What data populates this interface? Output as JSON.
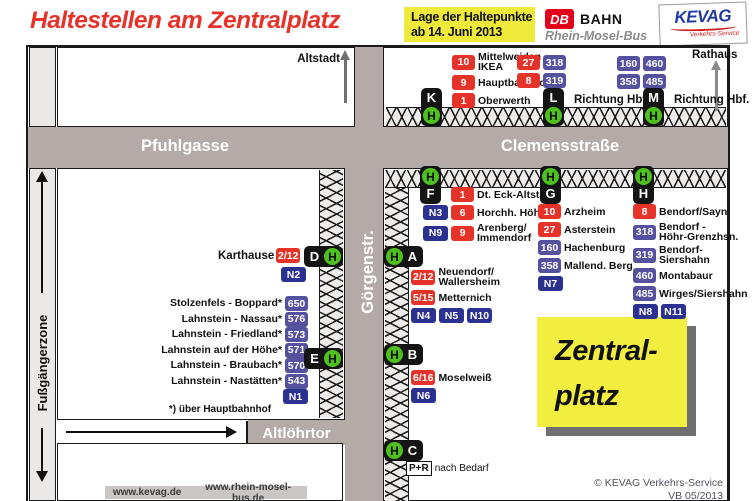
{
  "h_sign": "H",
  "header": {
    "title": "Haltestellen am Zentralplatz",
    "date_box": {
      "line1": "Lage der Haltepunkte",
      "line2": "ab 14. Juni 2013"
    },
    "db_logo": {
      "db": "DB",
      "bahn": "BAHN",
      "sub": "Rhein-Mosel-Bus"
    },
    "kevag_logo": {
      "name": "KEVAG",
      "sub": "Verkehrs-Service"
    }
  },
  "streets": {
    "pfuhlgasse": "Pfuhlgasse",
    "clemensstrasse": "Clemensstraße",
    "goergenstr": "Görgenstr.",
    "altloehrtor": "Altlöhrtor",
    "fussgaengerzone": "Fußgängerzone"
  },
  "landmarks": {
    "altstadt": "Altstadt",
    "rathaus": "Rathaus",
    "zentralplatz_line1": "Zentral-",
    "zentralplatz_line2": "platz"
  },
  "stops": {
    "K": {
      "letter": "K",
      "rows": [
        {
          "chips": [
            {
              "t": "10",
              "c": "red"
            }
          ],
          "label": "Mittelweiden\nIKEA"
        },
        {
          "chips": [
            {
              "t": "9",
              "c": "red"
            }
          ],
          "label": "Hauptbahnhof"
        },
        {
          "chips": [
            {
              "t": "1",
              "c": "red"
            }
          ],
          "label": "Oberwerth"
        }
      ]
    },
    "L": {
      "letter": "L",
      "direction": "Richtung Hbf.",
      "rows": [
        {
          "chips": [
            {
              "t": "27",
              "c": "red"
            },
            {
              "t": "318",
              "c": "pur"
            }
          ],
          "label": ""
        },
        {
          "chips": [
            {
              "t": "8",
              "c": "red"
            },
            {
              "t": "319",
              "c": "pur"
            }
          ],
          "label": ""
        }
      ]
    },
    "M": {
      "letter": "M",
      "direction": "Richtung Hbf.",
      "rows": [
        {
          "chips": [
            {
              "t": "160",
              "c": "pur"
            },
            {
              "t": "460",
              "c": "pur"
            }
          ],
          "label": ""
        },
        {
          "chips": [
            {
              "t": "358",
              "c": "pur"
            },
            {
              "t": "485",
              "c": "pur"
            }
          ],
          "label": ""
        }
      ]
    },
    "F": {
      "letter": "F",
      "rows": [
        {
          "chips": [
            {
              "t": "",
              "c": "sp"
            },
            {
              "t": "1",
              "c": "red"
            }
          ],
          "label": "Dt. Eck-Altstadt"
        },
        {
          "chips": [
            {
              "t": "N3",
              "c": "navy"
            },
            {
              "t": "6",
              "c": "red"
            }
          ],
          "label": "Horchh. Höhe"
        },
        {
          "chips": [
            {
              "t": "N9",
              "c": "navy"
            },
            {
              "t": "9",
              "c": "red"
            }
          ],
          "label": "Arenberg/\nImmendorf"
        }
      ]
    },
    "G": {
      "letter": "G",
      "rows": [
        {
          "chips": [
            {
              "t": "10",
              "c": "red"
            }
          ],
          "label": "Arzheim"
        },
        {
          "chips": [
            {
              "t": "27",
              "c": "red"
            }
          ],
          "label": "Asterstein"
        },
        {
          "chips": [
            {
              "t": "160",
              "c": "pur"
            }
          ],
          "label": "Hachenburg"
        },
        {
          "chips": [
            {
              "t": "358",
              "c": "pur"
            }
          ],
          "label": "Mallend. Berg"
        },
        {
          "chips": [
            {
              "t": "N7",
              "c": "navy"
            }
          ],
          "label": ""
        }
      ]
    },
    "H": {
      "letter": "H",
      "rows": [
        {
          "chips": [
            {
              "t": "8",
              "c": "red"
            }
          ],
          "label": "Bendorf/Sayn"
        },
        {
          "chips": [
            {
              "t": "318",
              "c": "pur"
            }
          ],
          "label": "Bendorf -\nHöhr-Grenzhsn."
        },
        {
          "chips": [
            {
              "t": "319",
              "c": "pur"
            }
          ],
          "label": "Bendorf-\nSiershahn"
        },
        {
          "chips": [
            {
              "t": "460",
              "c": "pur"
            }
          ],
          "label": "Montabaur"
        },
        {
          "chips": [
            {
              "t": "485",
              "c": "pur"
            }
          ],
          "label": "Wirges/Siershahn"
        },
        {
          "chips": [
            {
              "t": "N8",
              "c": "navy"
            },
            {
              "t": "N11",
              "c": "navy"
            }
          ],
          "label": ""
        }
      ]
    },
    "A": {
      "letter": "A",
      "rows": [
        {
          "chips": [
            {
              "t": "2/12",
              "c": "red"
            }
          ],
          "label": "Neuendorf/\nWallersheim"
        },
        {
          "chips": [
            {
              "t": "5/15",
              "c": "red"
            }
          ],
          "label": "Metternich"
        },
        {
          "chips": [
            {
              "t": "N4",
              "c": "navy"
            },
            {
              "t": "N5",
              "c": "navy"
            },
            {
              "t": "N10",
              "c": "navy"
            }
          ],
          "label": ""
        }
      ]
    },
    "B": {
      "letter": "B",
      "rows": [
        {
          "chips": [
            {
              "t": "6/16",
              "c": "red"
            }
          ],
          "label": "Moselweiß"
        },
        {
          "chips": [
            {
              "t": "N6",
              "c": "navy"
            }
          ],
          "label": ""
        }
      ]
    },
    "C": {
      "letter": "C",
      "rows": [
        {
          "chips": [
            {
              "t": "P+R",
              "c": "pr"
            }
          ],
          "label": "nach Bedarf"
        }
      ]
    },
    "D": {
      "letter": "D",
      "name": "Karthause",
      "line": "2/12",
      "night": "N2"
    },
    "E": {
      "letter": "E",
      "footnote": "*) über Hauptbahnhof",
      "rows": [
        {
          "chips": [
            {
              "t": "650",
              "c": "pur"
            }
          ],
          "label": "Stolzenfels - Boppard*"
        },
        {
          "chips": [
            {
              "t": "576",
              "c": "pur"
            }
          ],
          "label": "Lahnstein - Nassau*"
        },
        {
          "chips": [
            {
              "t": "573",
              "c": "pur"
            }
          ],
          "label": "Lahnstein - Friedland*"
        },
        {
          "chips": [
            {
              "t": "571",
              "c": "pur"
            }
          ],
          "label": "Lahnstein auf der Höhe*"
        },
        {
          "chips": [
            {
              "t": "570",
              "c": "pur"
            }
          ],
          "label": "Lahnstein - Braubach*"
        },
        {
          "chips": [
            {
              "t": "543",
              "c": "pur"
            }
          ],
          "label": "Lahnstein - Nastätten*"
        },
        {
          "chips": [
            {
              "t": "N1",
              "c": "navy"
            }
          ],
          "label": ""
        }
      ]
    }
  },
  "footer": {
    "kevag_url": "www.kevag.de",
    "rmb_url": "www.rhein-mosel-bus.de",
    "copyright": "© KEVAG Verkehrs-Service",
    "version": "VB 05/2013"
  },
  "colors": {
    "title_red": "#e5332a",
    "route_red": "#e5332a",
    "route_regional_purple": "#56519f",
    "route_night_navy": "#2b3191",
    "street_gray": "#b4aba8",
    "haltestelle_green": "#4fc11e",
    "highlight_yellow": "#f2ee3f"
  }
}
